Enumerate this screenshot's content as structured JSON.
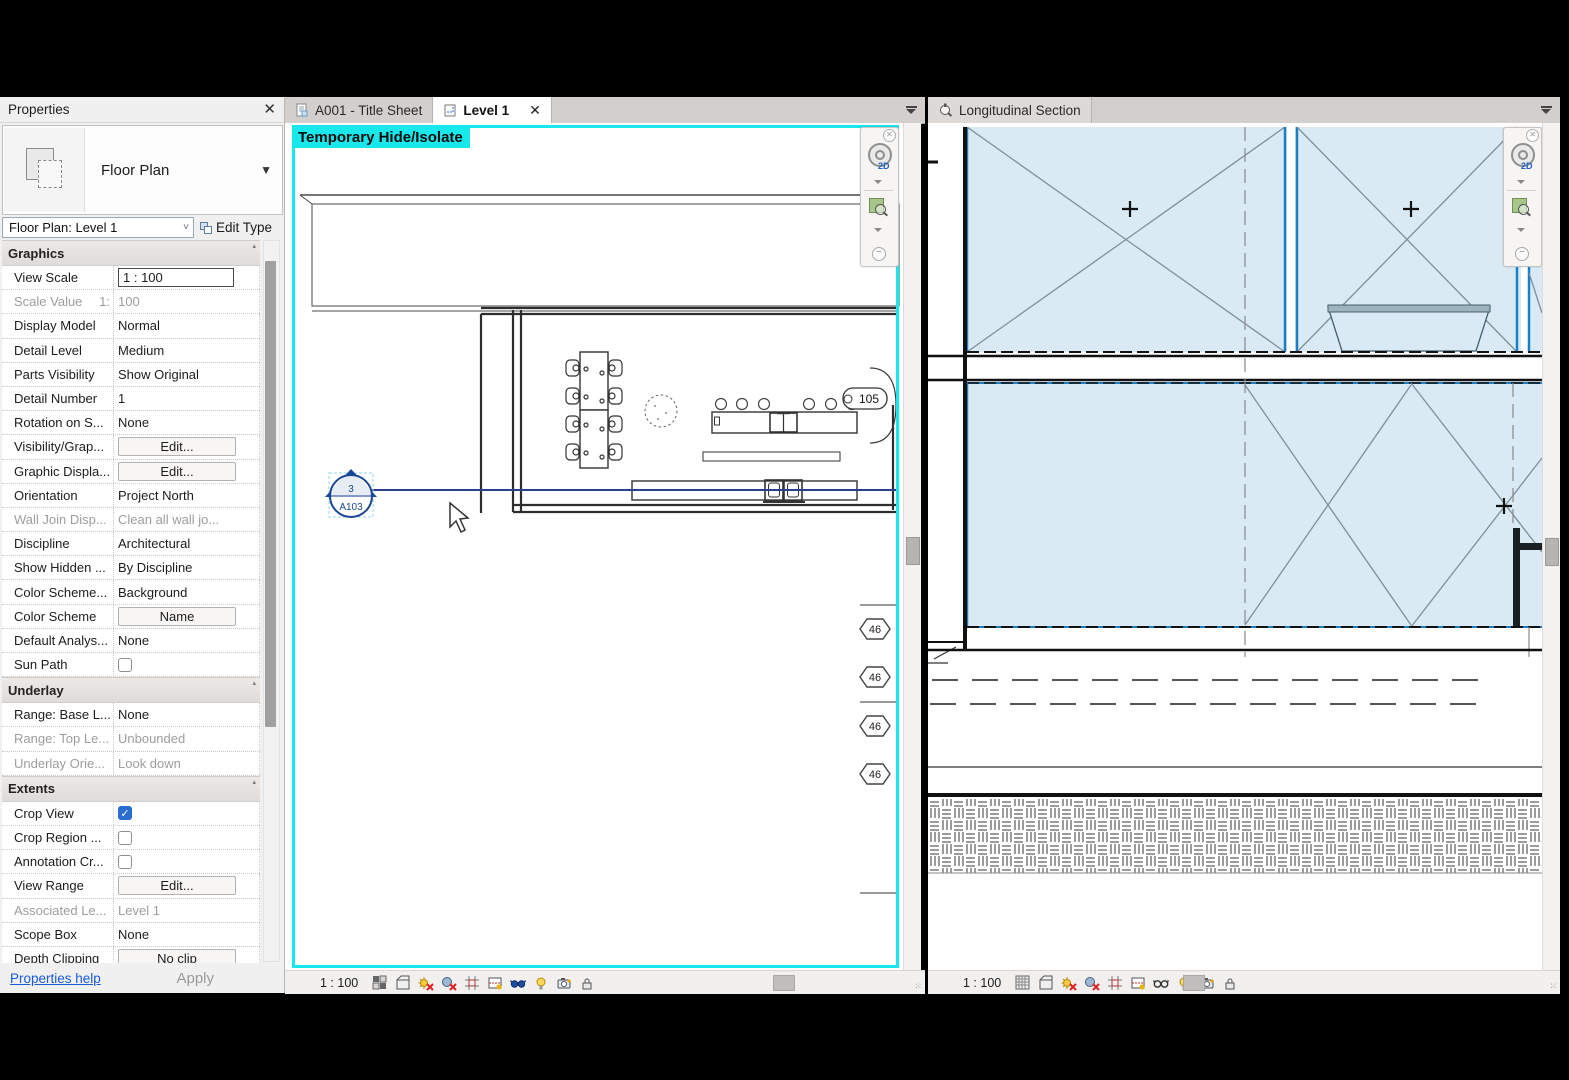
{
  "properties_panel": {
    "title": "Properties",
    "close_glyph": "✕",
    "type_selector": {
      "label": "Floor Plan"
    },
    "instance_selector": {
      "value": "Floor Plan: Level 1"
    },
    "edit_type_label": "Edit Type",
    "sections": [
      {
        "label": "Graphics",
        "rows": [
          {
            "name": "View Scale",
            "value": "1 : 100"
          },
          {
            "name": "Scale Value",
            "prefix": "1:",
            "value": "100"
          },
          {
            "name": "Display Model",
            "value": "Normal"
          },
          {
            "name": "Detail Level",
            "value": "Medium"
          },
          {
            "name": "Parts Visibility",
            "value": "Show Original"
          },
          {
            "name": "Detail Number",
            "value": "1"
          },
          {
            "name": "Rotation on S...",
            "value": "None"
          },
          {
            "name": "Visibility/Grap...",
            "value": "Edit..."
          },
          {
            "name": "Graphic Displa...",
            "value": "Edit..."
          },
          {
            "name": "Orientation",
            "value": "Project North"
          },
          {
            "name": "Wall Join Disp...",
            "value": "Clean all wall jo..."
          },
          {
            "name": "Discipline",
            "value": "Architectural"
          },
          {
            "name": "Show Hidden ...",
            "value": "By Discipline"
          },
          {
            "name": "Color Scheme...",
            "value": "Background"
          },
          {
            "name": "Color Scheme",
            "value": "Name"
          },
          {
            "name": "Default Analys...",
            "value": "None"
          },
          {
            "name": "Sun Path",
            "value": ""
          }
        ]
      },
      {
        "label": "Underlay",
        "rows": [
          {
            "name": "Range: Base L...",
            "value": "None"
          },
          {
            "name": "Range: Top Le...",
            "value": "Unbounded"
          },
          {
            "name": "Underlay Orie...",
            "value": "Look down"
          }
        ]
      },
      {
        "label": "Extents",
        "rows": [
          {
            "name": "Crop View",
            "value": ""
          },
          {
            "name": "Crop Region ...",
            "value": ""
          },
          {
            "name": "Annotation Cr...",
            "value": ""
          },
          {
            "name": "View Range",
            "value": "Edit..."
          },
          {
            "name": "Associated Le...",
            "value": "Level 1"
          },
          {
            "name": "Scope Box",
            "value": "None"
          },
          {
            "name": "Depth Clipping",
            "value": "No clip"
          }
        ]
      }
    ],
    "footer": {
      "help_label": "Properties help",
      "apply_label": "Apply"
    }
  },
  "left_pane": {
    "tabs": [
      {
        "label": "A001 - Title Sheet"
      },
      {
        "label": "Level 1"
      }
    ],
    "overlay_label": "Temporary Hide/Isolate",
    "view_scale_label": "1 : 100",
    "room_tag": "105",
    "section_marker": {
      "detail_number": "3",
      "sheet_number": "A103"
    },
    "level_tags": [
      "46",
      "46",
      "46",
      "46"
    ]
  },
  "right_pane": {
    "tabs": [
      {
        "label": "Longitudinal Section"
      }
    ],
    "view_scale_label": "1 : 100"
  },
  "view_control_icons": [
    {
      "name": "visual-style-icon"
    },
    {
      "name": "model-display-icon"
    },
    {
      "name": "sun-path-off-icon"
    },
    {
      "name": "shadows-off-icon"
    },
    {
      "name": "crop-view-icon"
    },
    {
      "name": "show-crop-region-icon"
    },
    {
      "name": "temporary-hide-isolate-icon"
    },
    {
      "name": "reveal-hidden-elements-icon"
    },
    {
      "name": "analytical-model-icon"
    },
    {
      "name": "lock-view-icon"
    }
  ],
  "navigation_bar_icons": [
    {
      "name": "close-icon"
    },
    {
      "name": "steering-wheel-2d-icon"
    },
    {
      "name": "expand-arrow-icon"
    },
    {
      "name": "zoom-region-icon"
    },
    {
      "name": "expand-arrow-icon"
    },
    {
      "name": "collapse-icon"
    }
  ],
  "colors": {
    "crop_accent": "#18e7ec",
    "section_blue": "#1b4596",
    "room_fill": "#d9eaf4",
    "room_edge": "#1a80c4",
    "checkbox_blue": "#2a6dd0",
    "link_blue": "#1a5cd7"
  }
}
